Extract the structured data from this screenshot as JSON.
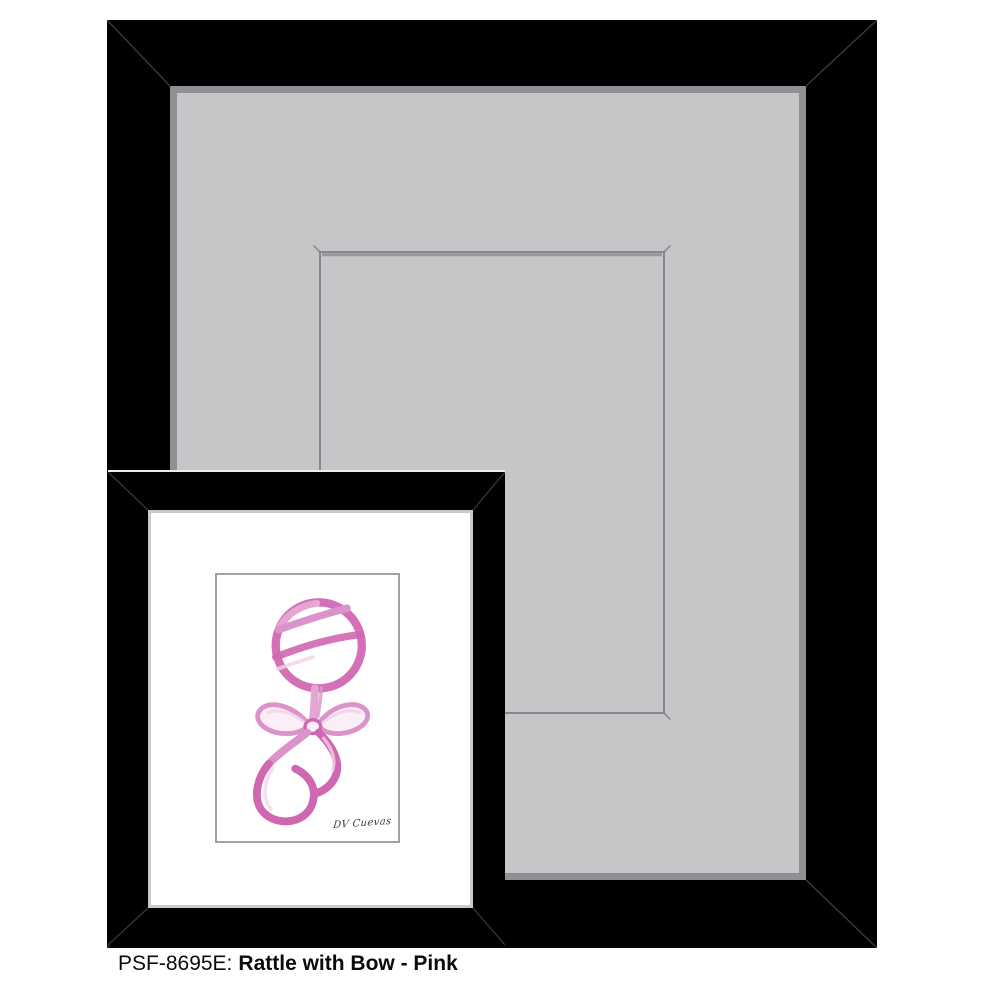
{
  "caption": {
    "sku": "PSF-8695E:",
    "title": "Rattle with Bow - Pink"
  },
  "artwork": {
    "signature": "DV Cuevas"
  },
  "colors": {
    "frame_black": "#000000",
    "mat_gray": "#c5c6c8",
    "mat_bevel": "#8e9093",
    "opening_line": "#85878a",
    "small_mat": "#ffffff",
    "small_bevel": "#c9c9c9",
    "artwork_border": "#a2a2a2",
    "pink_main": "#d470b8",
    "pink_mid": "#dc93c9",
    "pink_deep": "#cf67b1",
    "pink_light": "#e5a6d3",
    "pink_pale": "#f3d2e8",
    "pink_fill": "#fbeff7",
    "signature_ink": "#3d3d47",
    "caption_text": "#0b0b0b"
  }
}
